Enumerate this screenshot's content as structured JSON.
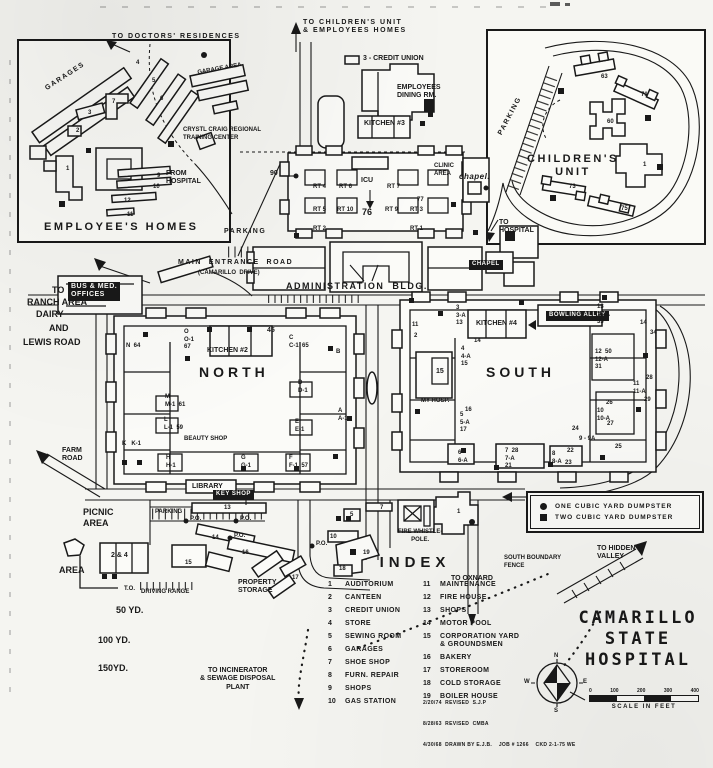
{
  "colors": {
    "ink": "#191919",
    "paper": "#f5f5f1"
  },
  "title": {
    "lines": [
      "CAMARILLO",
      "STATE",
      "HOSPITAL"
    ]
  },
  "legend": {
    "items": [
      {
        "symbol": "circle",
        "label": "ONE CUBIC YARD DUMPSTER"
      },
      {
        "symbol": "square",
        "label": "TWO CUBIC YARD DUMPSTER"
      }
    ]
  },
  "index": {
    "heading": "INDEX",
    "col1": [
      {
        "num": "1",
        "label": "AUDITORIUM"
      },
      {
        "num": "2",
        "label": "CANTEEN"
      },
      {
        "num": "3",
        "label": "CREDIT UNION"
      },
      {
        "num": "4",
        "label": "STORE"
      },
      {
        "num": "5",
        "label": "SEWING ROOM"
      },
      {
        "num": "6",
        "label": "GARAGES"
      },
      {
        "num": "7",
        "label": "SHOE SHOP"
      },
      {
        "num": "8",
        "label": "FURN. REPAIR"
      },
      {
        "num": "9",
        "label": "SHOPS"
      },
      {
        "num": "10",
        "label": "GAS STATION"
      }
    ],
    "col2": [
      {
        "num": "11",
        "label": "MAINTENANCE"
      },
      {
        "num": "12",
        "label": "FIRE HOUSE"
      },
      {
        "num": "13",
        "label": "SHOPS"
      },
      {
        "num": "14",
        "label": "MOTOR POOL"
      },
      {
        "num": "15",
        "label": "CORPORATION YARD & GROUNDSMEN"
      },
      {
        "num": "16",
        "label": "BAKERY"
      },
      {
        "num": "17",
        "label": "STOREROOM"
      },
      {
        "num": "18",
        "label": "COLD STORAGE"
      },
      {
        "num": "19",
        "label": "BOILER HOUSE"
      }
    ]
  },
  "scale": {
    "ticks": [
      "0",
      "100",
      "200",
      "300",
      "400"
    ],
    "caption": "SCALE IN FEET"
  },
  "compass": {
    "n": "N",
    "e": "E",
    "s": "S",
    "w": "W"
  },
  "revision": {
    "lines": [
      "2/20/74  REVISED  S.J.P",
      "8/28/63  REVISED  CMBA",
      "4/30/68  DRAWN BY E.J.B.    JOB # 1266    CKD 2-1-75 WE"
    ]
  },
  "map_labels": [
    {
      "t": "TO DOCTORS' RESIDENCES",
      "x": 112,
      "y": 33,
      "cls": "xs sp",
      "n": "label-to-doctors-residences"
    },
    {
      "t": "GARAGES",
      "x": 44,
      "y": 86,
      "rot": -33,
      "cls": "xs sp",
      "n": "label-garages"
    },
    {
      "t": "GARAGE AREA",
      "x": 197,
      "y": 70,
      "rot": -10,
      "cls": "num",
      "n": "label-garage-area"
    },
    {
      "t": "4",
      "x": 136,
      "y": 60,
      "cls": "num"
    },
    {
      "t": "5",
      "x": 152,
      "y": 78,
      "cls": "num"
    },
    {
      "t": "6",
      "x": 160,
      "y": 96,
      "cls": "num"
    },
    {
      "t": "7",
      "x": 112,
      "y": 99,
      "cls": "num"
    },
    {
      "t": "3",
      "x": 88,
      "y": 110,
      "cls": "num"
    },
    {
      "t": "2",
      "x": 76,
      "y": 128,
      "cls": "num"
    },
    {
      "t": "1",
      "x": 66,
      "y": 166,
      "cls": "num"
    },
    {
      "t": "9",
      "x": 157,
      "y": 173,
      "cls": "num"
    },
    {
      "t": "10",
      "x": 153,
      "y": 184,
      "cls": "num"
    },
    {
      "t": "12",
      "x": 124,
      "y": 198,
      "cls": "num"
    },
    {
      "t": "11",
      "x": 127,
      "y": 212,
      "cls": "num"
    },
    {
      "t": "CRYSTL CRAIG REGIONAL\nTRAINING CENTER",
      "x": 183,
      "y": 127,
      "cls": "num",
      "n": "label-training-center"
    },
    {
      "t": "FROM\nHOSPITAL",
      "x": 166,
      "y": 170,
      "cls": "xs",
      "n": "label-from-hospital"
    },
    {
      "t": "EMPLOYEE'S HOMES",
      "x": 44,
      "y": 221,
      "cls": "lg",
      "n": "label-employees-homes"
    },
    {
      "t": "TO CHILDREN'S UNIT\n& EMPLOYEES HOMES",
      "x": 303,
      "y": 19,
      "cls": "xs sp",
      "n": "label-to-childrens-unit"
    },
    {
      "t": "3 - CREDIT UNION",
      "x": 363,
      "y": 55,
      "cls": "xs",
      "n": "label-credit-union"
    },
    {
      "t": "EMPLOYEES\nDINING RM.",
      "x": 397,
      "y": 84,
      "cls": "xs",
      "n": "label-employees-dining"
    },
    {
      "t": "KITCHEN #3",
      "x": 364,
      "y": 120,
      "cls": "xs",
      "n": "label-kitchen-3"
    },
    {
      "t": "PARKING",
      "x": 224,
      "y": 228,
      "cls": "xs sp",
      "n": "label-parking-main"
    },
    {
      "t": "PARKING",
      "x": 497,
      "y": 133,
      "rot": -62,
      "cls": "xs sp",
      "n": "label-parking-childrens"
    },
    {
      "t": "CHILDREN'S\nUNIT",
      "x": 527,
      "y": 153,
      "cls": "lg ctr",
      "n": "label-childrens-unit"
    },
    {
      "t": "TO\nHOSPITAL",
      "x": 499,
      "y": 219,
      "cls": "xs",
      "n": "label-to-hospital"
    },
    {
      "t": "63",
      "x": 601,
      "y": 74,
      "cls": "num"
    },
    {
      "t": "71",
      "x": 641,
      "y": 92,
      "cls": "num"
    },
    {
      "t": "60",
      "x": 607,
      "y": 119,
      "cls": "num"
    },
    {
      "t": "1",
      "x": 643,
      "y": 162,
      "cls": "num"
    },
    {
      "t": "73",
      "x": 569,
      "y": 184,
      "cls": "num"
    },
    {
      "t": "75",
      "x": 621,
      "y": 206,
      "cls": "num"
    },
    {
      "t": "90",
      "x": 270,
      "y": 170,
      "cls": "xs",
      "n": "label-bldg-90"
    },
    {
      "t": "ICU",
      "x": 361,
      "y": 177,
      "cls": "xs",
      "n": "label-icu"
    },
    {
      "t": "76",
      "x": 362,
      "y": 207,
      "cls": "md"
    },
    {
      "t": "RT 4",
      "x": 313,
      "y": 184,
      "cls": "num"
    },
    {
      "t": "RT 6",
      "x": 339,
      "y": 184,
      "cls": "num"
    },
    {
      "t": "RT 7",
      "x": 387,
      "y": 184,
      "cls": "num"
    },
    {
      "t": "77",
      "x": 417,
      "y": 197,
      "cls": "num"
    },
    {
      "t": "RT 5",
      "x": 313,
      "y": 207,
      "cls": "num"
    },
    {
      "t": "RT 10",
      "x": 337,
      "y": 207,
      "cls": "num"
    },
    {
      "t": "RT 9",
      "x": 385,
      "y": 207,
      "cls": "num"
    },
    {
      "t": "RT 3",
      "x": 410,
      "y": 207,
      "cls": "num"
    },
    {
      "t": "RT 2",
      "x": 313,
      "y": 226,
      "cls": "num"
    },
    {
      "t": "RT 1",
      "x": 410,
      "y": 226,
      "cls": "num"
    },
    {
      "t": "CLINIC\nAREA",
      "x": 434,
      "y": 163,
      "cls": "num",
      "n": "label-clinic-area"
    },
    {
      "t": "chapel.",
      "x": 459,
      "y": 172,
      "cls": "script",
      "n": "label-chapel-small"
    },
    {
      "t": "MAIN  ENTRANCE  ROAD",
      "x": 178,
      "y": 259,
      "cls": "xs sp",
      "n": "label-main-entrance-road"
    },
    {
      "t": "(CAMARILLO  DRIVE)",
      "x": 198,
      "y": 270,
      "cls": "num",
      "n": "label-camarillo-drive"
    },
    {
      "t": "TO",
      "x": 52,
      "y": 285,
      "cls": "md"
    },
    {
      "t": "RANCH AREA",
      "x": 27,
      "y": 297,
      "cls": "md",
      "n": "label-ranch-area"
    },
    {
      "t": "DAIRY",
      "x": 36,
      "y": 309,
      "cls": "md"
    },
    {
      "t": "AND",
      "x": 49,
      "y": 323,
      "cls": "md"
    },
    {
      "t": "LEWIS ROAD",
      "x": 23,
      "y": 337,
      "cls": "md",
      "n": "label-lewis-road"
    },
    {
      "t": "BUS & MED.\nOFFICES",
      "x": 68,
      "y": 282,
      "cls": "chip xs",
      "n": "label-bus-med-offices"
    },
    {
      "t": "ADMINISTRATION  BLDG.",
      "x": 286,
      "y": 281,
      "cls": "md sp",
      "n": "label-administration-bldg"
    },
    {
      "t": "CHAPEL",
      "x": 469,
      "y": 260,
      "cls": "chip num",
      "n": "label-chapel"
    },
    {
      "t": "NORTH",
      "x": 199,
      "y": 364,
      "cls": "xl",
      "n": "label-north-quad"
    },
    {
      "t": "KITCHEN #2",
      "x": 207,
      "y": 347,
      "cls": "xs",
      "n": "label-kitchen-2"
    },
    {
      "t": "45",
      "x": 267,
      "y": 327,
      "cls": "xs"
    },
    {
      "t": "N  64",
      "x": 126,
      "y": 343,
      "cls": "num"
    },
    {
      "t": "O\nO-1\n67",
      "x": 184,
      "y": 329,
      "cls": "num"
    },
    {
      "t": "C\nC-1  65",
      "x": 289,
      "y": 335,
      "cls": "num"
    },
    {
      "t": "B",
      "x": 336,
      "y": 349,
      "cls": "num"
    },
    {
      "t": "M\nM-1  61",
      "x": 165,
      "y": 394,
      "cls": "num"
    },
    {
      "t": "D\nD-1",
      "x": 298,
      "y": 380,
      "cls": "num"
    },
    {
      "t": "L\nL-1  59",
      "x": 164,
      "y": 417,
      "cls": "num"
    },
    {
      "t": "E\nE-1",
      "x": 295,
      "y": 419,
      "cls": "num"
    },
    {
      "t": "K   K-1",
      "x": 122,
      "y": 441,
      "cls": "num"
    },
    {
      "t": "A\nA-1",
      "x": 338,
      "y": 408,
      "cls": "num"
    },
    {
      "t": "BEAUTY SHOP",
      "x": 184,
      "y": 436,
      "cls": "num",
      "n": "label-beauty-shop"
    },
    {
      "t": "H\nH-1",
      "x": 166,
      "y": 455,
      "cls": "num"
    },
    {
      "t": "G\nG-1",
      "x": 241,
      "y": 455,
      "cls": "num"
    },
    {
      "t": "F\nF-1  57",
      "x": 289,
      "y": 455,
      "cls": "num"
    },
    {
      "t": "LIBRARY",
      "x": 192,
      "y": 483,
      "cls": "xs",
      "n": "label-library"
    },
    {
      "t": "SOUTH",
      "x": 486,
      "y": 364,
      "cls": "xl",
      "n": "label-south-quad"
    },
    {
      "t": "KITCHEN #4",
      "x": 476,
      "y": 320,
      "cls": "xs",
      "n": "label-kitchen-4"
    },
    {
      "t": "BOWLING ALLEY",
      "x": 546,
      "y": 311,
      "cls": "chip num",
      "n": "label-bowling-alley"
    },
    {
      "t": "MY HOSP.",
      "x": 421,
      "y": 398,
      "cls": "num",
      "n": "label-my-hosp"
    },
    {
      "t": "11",
      "x": 412,
      "y": 322,
      "cls": "num"
    },
    {
      "t": "2",
      "x": 414,
      "y": 333,
      "cls": "num"
    },
    {
      "t": "3\n3-A\n13",
      "x": 456,
      "y": 305,
      "cls": "num"
    },
    {
      "t": "13\n13-A\n33",
      "x": 597,
      "y": 304,
      "cls": "num"
    },
    {
      "t": "14",
      "x": 640,
      "y": 320,
      "cls": "num"
    },
    {
      "t": "34",
      "x": 650,
      "y": 330,
      "cls": "num"
    },
    {
      "t": "14",
      "x": 474,
      "y": 338,
      "cls": "num"
    },
    {
      "t": "4\n4-A\n15",
      "x": 461,
      "y": 346,
      "cls": "num"
    },
    {
      "t": "12  50\n12-A\n31",
      "x": 595,
      "y": 349,
      "cls": "num"
    },
    {
      "t": "15",
      "x": 436,
      "y": 368,
      "cls": "xs"
    },
    {
      "t": "16",
      "x": 465,
      "y": 407,
      "cls": "num"
    },
    {
      "t": "5\n5-A\n17",
      "x": 460,
      "y": 412,
      "cls": "num"
    },
    {
      "t": "11\n11-A",
      "x": 633,
      "y": 381,
      "cls": "num"
    },
    {
      "t": "28",
      "x": 646,
      "y": 375,
      "cls": "num"
    },
    {
      "t": "29",
      "x": 644,
      "y": 397,
      "cls": "num"
    },
    {
      "t": "26",
      "x": 606,
      "y": 400,
      "cls": "num"
    },
    {
      "t": "10\n10-A",
      "x": 597,
      "y": 408,
      "cls": "num"
    },
    {
      "t": "27",
      "x": 607,
      "y": 421,
      "cls": "num"
    },
    {
      "t": "24",
      "x": 572,
      "y": 426,
      "cls": "num"
    },
    {
      "t": "9 - 9A",
      "x": 579,
      "y": 436,
      "cls": "num"
    },
    {
      "t": "22",
      "x": 567,
      "y": 448,
      "cls": "num"
    },
    {
      "t": "8\n8-A",
      "x": 552,
      "y": 451,
      "cls": "num"
    },
    {
      "t": "23",
      "x": 565,
      "y": 460,
      "cls": "num"
    },
    {
      "t": "25",
      "x": 615,
      "y": 444,
      "cls": "num"
    },
    {
      "t": "7  28\n7-A\n21",
      "x": 505,
      "y": 448,
      "cls": "num"
    },
    {
      "t": "6\n6-A",
      "x": 458,
      "y": 450,
      "cls": "num"
    },
    {
      "t": "FARM\nROAD",
      "x": 62,
      "y": 447,
      "cls": "xs",
      "n": "label-farm-road"
    },
    {
      "t": "PICNIC\nAREA",
      "x": 83,
      "y": 507,
      "cls": "md",
      "n": "label-picnic-area"
    },
    {
      "t": "AREA",
      "x": 59,
      "y": 565,
      "cls": "md",
      "n": "label-area"
    },
    {
      "t": "2 & 4",
      "x": 111,
      "y": 552,
      "cls": "xs"
    },
    {
      "t": "KEY SHOP",
      "x": 213,
      "y": 490,
      "cls": "chip num",
      "n": "label-key-shop"
    },
    {
      "t": "PARKING",
      "x": 155,
      "y": 509,
      "cls": "num"
    },
    {
      "t": "13",
      "x": 224,
      "y": 505,
      "cls": "num"
    },
    {
      "t": "P.O.",
      "x": 190,
      "y": 516,
      "cls": "num"
    },
    {
      "t": "P.O.",
      "x": 240,
      "y": 516,
      "cls": "num"
    },
    {
      "t": "P.O.",
      "x": 234,
      "y": 533,
      "cls": "num"
    },
    {
      "t": "P.O.",
      "x": 316,
      "y": 541,
      "cls": "num"
    },
    {
      "t": "14",
      "x": 212,
      "y": 535,
      "cls": "num"
    },
    {
      "t": "16",
      "x": 242,
      "y": 550,
      "cls": "num"
    },
    {
      "t": "15",
      "x": 185,
      "y": 560,
      "cls": "num"
    },
    {
      "t": "17",
      "x": 292,
      "y": 575,
      "cls": "num"
    },
    {
      "t": "19",
      "x": 363,
      "y": 550,
      "cls": "num"
    },
    {
      "t": "18",
      "x": 339,
      "y": 566,
      "cls": "num"
    },
    {
      "t": "5",
      "x": 350,
      "y": 512,
      "cls": "num"
    },
    {
      "t": "7",
      "x": 380,
      "y": 505,
      "cls": "num"
    },
    {
      "t": "10",
      "x": 330,
      "y": 534,
      "cls": "num"
    },
    {
      "t": "1",
      "x": 457,
      "y": 509,
      "cls": "num"
    },
    {
      "t": "T.O.",
      "x": 124,
      "y": 586,
      "cls": "num"
    },
    {
      "t": "DRIVING RANGE",
      "x": 141,
      "y": 589,
      "cls": "num",
      "n": "label-driving-range"
    },
    {
      "t": "50 YD.",
      "x": 116,
      "y": 605,
      "cls": "md",
      "n": "label-50yd"
    },
    {
      "t": "100 YD.",
      "x": 98,
      "y": 635,
      "cls": "md",
      "n": "label-100yd"
    },
    {
      "t": "150YD.",
      "x": 98,
      "y": 663,
      "cls": "md",
      "n": "label-150yd"
    },
    {
      "t": "PROPERTY\nSTORAGE",
      "x": 238,
      "y": 579,
      "cls": "xs",
      "n": "label-property-storage"
    },
    {
      "t": "FIRE WHISTLE-\nPOLE.",
      "x": 398,
      "y": 529,
      "cls": "num ctr",
      "n": "label-fire-whistle-pole"
    },
    {
      "t": "TO INCINERATOR\n& SEWAGE DISPOSAL\nPLANT",
      "x": 200,
      "y": 667,
      "cls": "xs ctr",
      "n": "label-to-incinerator"
    },
    {
      "t": "TO OXNARD",
      "x": 451,
      "y": 575,
      "cls": "xs",
      "n": "label-to-oxnard"
    },
    {
      "t": "SOUTH BOUNDARY\nFENCE",
      "x": 504,
      "y": 555,
      "cls": "num",
      "n": "label-south-boundary-fence"
    },
    {
      "t": "TO HIDDEN\nVALLEY",
      "x": 597,
      "y": 545,
      "cls": "xs",
      "n": "label-to-hidden-valley"
    }
  ]
}
